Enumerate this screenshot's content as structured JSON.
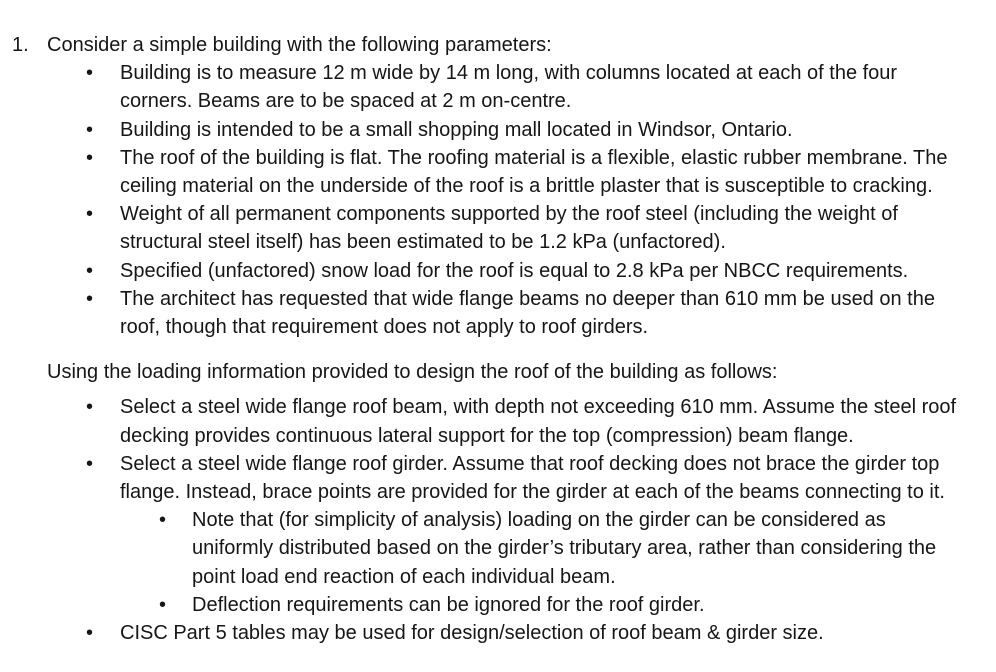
{
  "page": {
    "background_color": "#ffffff",
    "text_color": "#161616"
  },
  "problem": {
    "bullet_glyph": "•",
    "number": "1.",
    "intro": "Consider a simple building with the following parameters:",
    "parameters": [
      "Building is to measure 12 m wide by 14 m long, with columns located at each of the four corners. Beams are to be spaced at 2 m on-centre.",
      "Building is intended to be a small shopping mall located in Windsor, Ontario.",
      "The roof of the building is flat. The roofing material is a flexible, elastic rubber membrane. The ceiling material on the underside of the roof is a brittle plaster that is susceptible to cracking.",
      "Weight of all permanent components supported by the roof steel (including the weight of structural steel itself) has been estimated to be 1.2 kPa (unfactored).",
      "Specified (unfactored) snow load for the roof is equal to 2.8 kPa per NBCC requirements.",
      "The architect has requested that wide flange beams no deeper than 610 mm be used on the roof, though that requirement does not apply to roof girders."
    ],
    "task_intro": "Using the loading information provided to design the roof of the building as follows:",
    "tasks": [
      {
        "text": "Select a steel wide flange roof beam, with depth not exceeding 610 mm. Assume the steel roof decking provides continuous lateral support for the top (compression) beam flange."
      },
      {
        "text": "Select a steel wide flange roof girder. Assume that roof decking does not brace the girder top flange. Instead, brace points are provided for the girder at each of the beams connecting to it.",
        "subitems": [
          "Note that (for simplicity of analysis) loading on the girder can be considered as uniformly distributed based on the girder’s tributary area, rather than considering the point load end reaction of each individual beam.",
          "Deflection requirements can be ignored for the roof girder."
        ]
      },
      {
        "text": "CISC Part 5 tables may be used for design/selection of roof beam & girder size."
      }
    ]
  }
}
